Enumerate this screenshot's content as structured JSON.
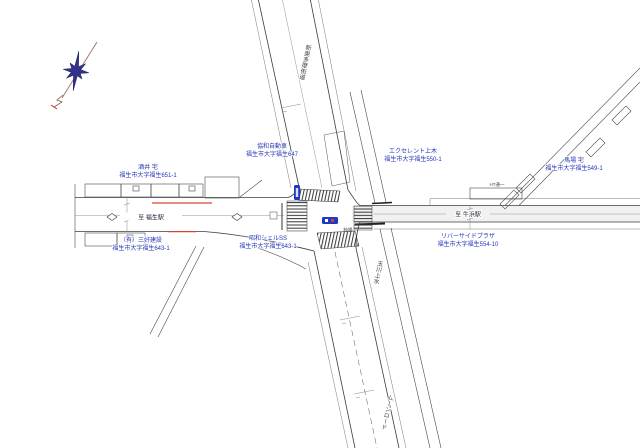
{
  "colors": {
    "label_blue": "#2536b8",
    "signal_blue": "#1d39c4",
    "red_mark": "#dd4433",
    "line_dark": "#3c3c3c",
    "compass_star": "#32328c"
  },
  "icons": {
    "compass": "north-compass-rose",
    "signal": "traffic-signal-badge",
    "pavement_diamond": "crosswalk-ahead-diamond"
  },
  "labels": [
    {
      "id": "sakai-house",
      "line1": "酒井 宅",
      "line2": "福生市大字福生651-1"
    },
    {
      "id": "kyowa-auto",
      "line1": "協和自動車",
      "line2": "福生市大字福生647"
    },
    {
      "id": "excellent-uemoto",
      "line1": "エクセレント上木",
      "line2": "福生市大字福生550-1"
    },
    {
      "id": "baba-house",
      "line1": "馬場 宅",
      "line2": "福生市大字福生549-1"
    },
    {
      "id": "riverside-plaza",
      "line1": "リバーサイドプラザ",
      "line2": "福生市大字福生554-10"
    },
    {
      "id": "showa-shell",
      "line1": "昭和シェルSS",
      "line2": "福生市大字福生643-1"
    },
    {
      "id": "yugen-kensetsu",
      "line1": "（有）三好建設",
      "line2": "福生市大字福生643-1"
    }
  ],
  "road_labels": {
    "to_fussa_station": "至 福生駅",
    "to_ushihama_station": "至 牛浜駅",
    "shin_okutama_kaido": "新奥多摩街道",
    "tamagawa_josui": "玉川上水",
    "moon_road": "ムーンロード",
    "mutsumi_bridge": "睦橋",
    "building_note": "HT通一"
  }
}
